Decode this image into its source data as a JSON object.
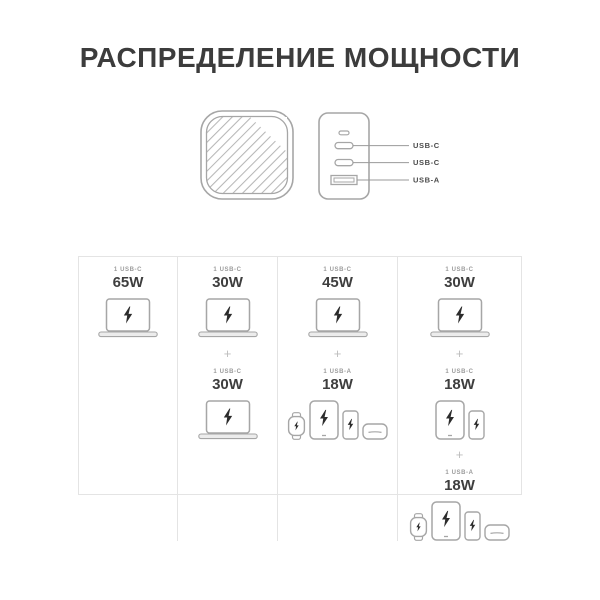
{
  "title": "РАСПРЕДЕЛЕНИЕ МОЩНОСТИ",
  "plus": "+",
  "charger": {
    "ports": [
      {
        "label": "USB-C"
      },
      {
        "label": "USB-C"
      },
      {
        "label": "USB-A"
      }
    ]
  },
  "table": {
    "columns": [
      {
        "groups": [
          {
            "port": "1 USB-C",
            "watt": "65W",
            "devices": [
              "laptop"
            ]
          }
        ]
      },
      {
        "groups": [
          {
            "port": "1 USB-C",
            "watt": "30W",
            "devices": [
              "laptop"
            ]
          },
          {
            "port": "1 USB-C",
            "watt": "30W",
            "devices": [
              "laptop"
            ]
          }
        ]
      },
      {
        "groups": [
          {
            "port": "1 USB-C",
            "watt": "45W",
            "devices": [
              "laptop"
            ]
          },
          {
            "port": "1 USB-A",
            "watt": "18W",
            "devices": [
              "watch",
              "tablet",
              "phone",
              "earbuds"
            ]
          }
        ]
      },
      {
        "groups": [
          {
            "port": "1 USB-C",
            "watt": "30W",
            "devices": [
              "laptop"
            ]
          },
          {
            "port": "1 USB-C",
            "watt": "18W",
            "devices": [
              "tablet",
              "phone"
            ]
          },
          {
            "port": "1 USB-A",
            "watt": "18W",
            "devices": [
              "watch",
              "tablet",
              "phone",
              "earbuds"
            ]
          }
        ]
      }
    ]
  },
  "colors": {
    "text": "#3c3c3c",
    "label_gray": "#9b9b9b",
    "outline_gray": "#a6a6a6",
    "hatch_gray": "#b6b6b6",
    "bolt_black": "#2c2c2c",
    "border_light": "#e4e4e4",
    "plus_gray": "#bdbdbd"
  }
}
